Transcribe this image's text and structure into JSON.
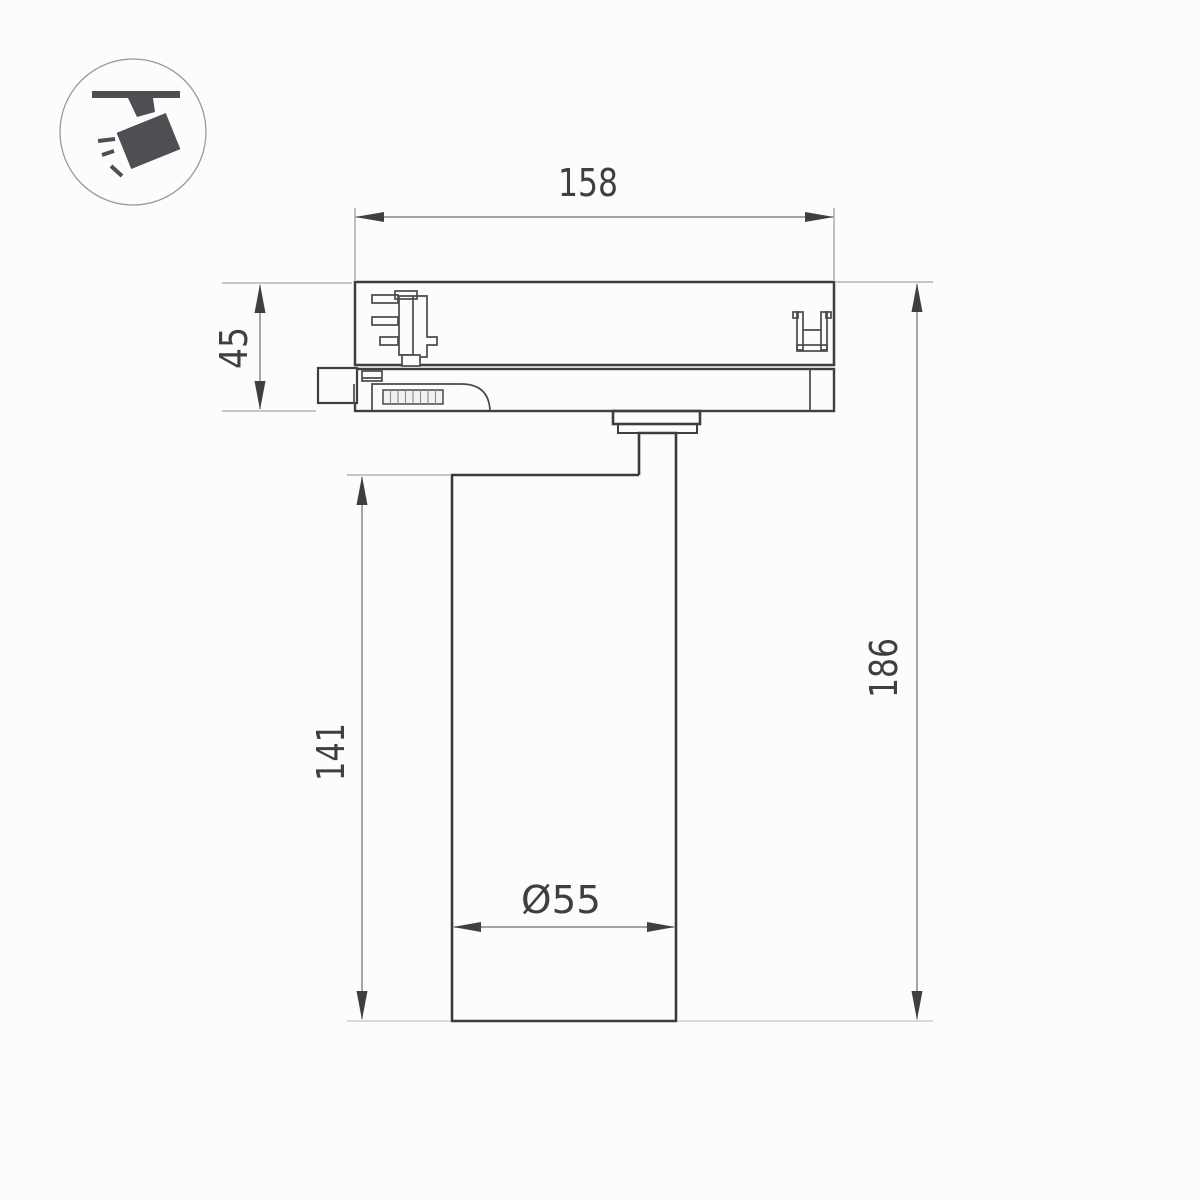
{
  "icon": {
    "name": "track-spotlight-icon"
  },
  "dimensions": {
    "adapter_width": "158",
    "adapter_height": "45",
    "body_height": "141",
    "total_height": "186",
    "body_diameter": "Ø55"
  },
  "colors": {
    "outline": "#3f3f3f",
    "dim_line": "#6e6e6e",
    "ext_line": "#8f8f8f",
    "ext_line_light": "#c4c4c4",
    "icon_fill": "#4d4f53",
    "text": "#3f3f3f",
    "background": "#fcfcfc"
  }
}
